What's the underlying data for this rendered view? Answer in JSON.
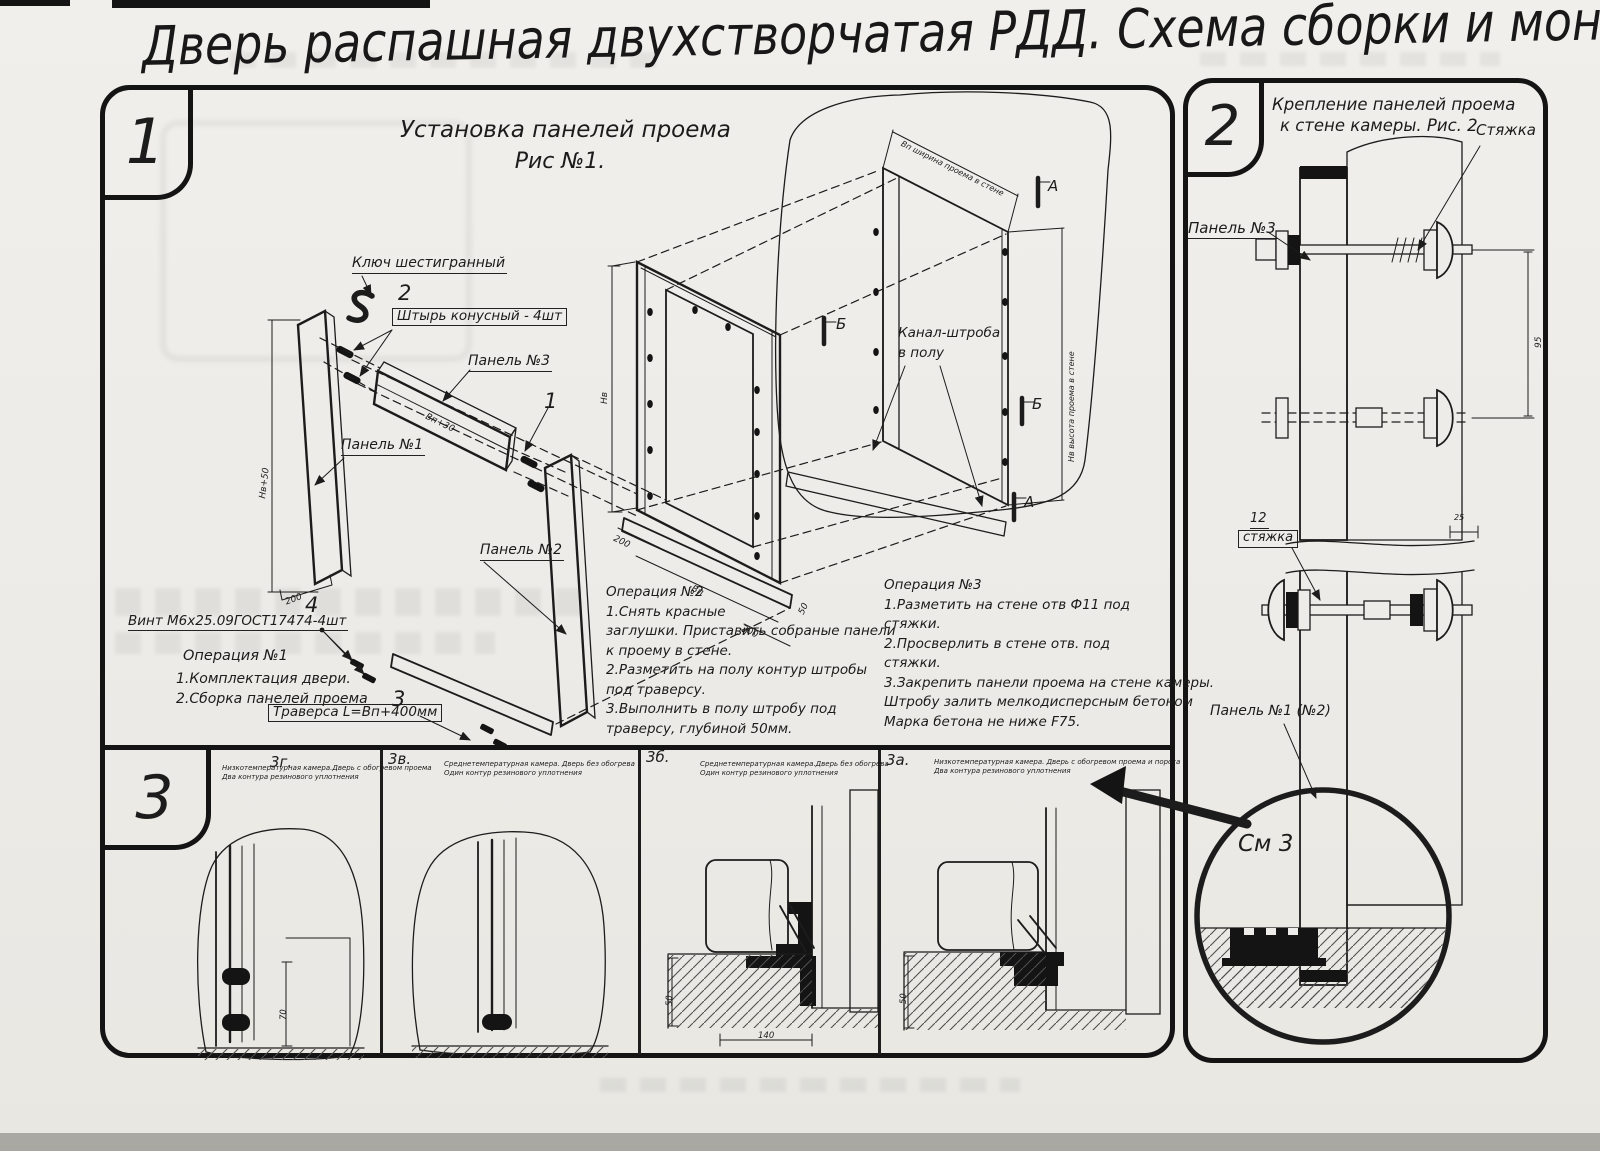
{
  "title": "Дверь распашная двухстворчатая РДД.  Схема сборки и монтажа №2",
  "s1": {
    "badge": "1",
    "title1": "Установка панелей проема",
    "title2": "Рис №1.",
    "lbl_key": "Ключ шестигранный",
    "lbl_pin": "Штырь конусный - 4шт",
    "lbl_p3": "Панель №3",
    "lbl_p1": "Панель №1",
    "lbl_p2": "Панель №2",
    "lbl_screw": "Винт М6х25.09ГОСТ17474-4шт",
    "lbl_trav": "Траверса  L=Вп+400мм",
    "c1": "1",
    "c2": "2",
    "c3": "3",
    "c4": "4",
    "op1_t": "Операция №1",
    "op1_lines": [
      "1.Комплектация двери.",
      "2.Сборка панелей проема"
    ],
    "op2_t": "Операция №2",
    "op2_lines": [
      "1.Снять красные",
      "заглушки. Приставить собраные панели",
      "к проему в стене.",
      "2.Разметить на полу контур штробы",
      "под траверсу.",
      "3.Выполнить в полу штробу под",
      "траверсу, глубиной 50мм."
    ],
    "op3_t": "Операция №3",
    "op3_lines": [
      "1.Разметить на стене отв Ф11 под",
      "стяжки.",
      "2.Просверлить в стене отв.  под",
      "стяжки.",
      "3.Закрепить панели проема на стене камеры.",
      "Штробу залить мелкодисперсным бетоном",
      "Марка бетона не ниже  F75."
    ],
    "chan1": "Канал-штроба",
    "chan2": "в полу",
    "mA": "А",
    "mB": "Б",
    "dim_h150": "Нв+50",
    "dim_200": "200",
    "dim_b30": "Вп+30",
    "dim_hn": "Нв",
    "dim_bn": "Вп",
    "dim_50": "50",
    "dim_wall_w": "Вп ширина проема в стене",
    "dim_wall_h": "Нв высота проема в стене"
  },
  "s2": {
    "badge": "2",
    "title1": "Крепление панелей проема",
    "title2": "к стене камеры. Рис. 2",
    "lbl_tie": "Стяжка",
    "lbl_p3": "Панель №3",
    "lbl_12": "12",
    "lbl_tie2": "стяжка",
    "lbl_p12": "Панель №1 (№2)",
    "see3": "См 3",
    "dim95": "95",
    "dim25": "25"
  },
  "s3": {
    "badge": "3",
    "panels": [
      {
        "id": "3г.",
        "cap1": "Низкотемпературная камера.Дверь с обогревом проема",
        "cap2": "Два контура резинового уплотнения"
      },
      {
        "id": "3в.",
        "cap1": "Среднетемпературная камера. Дверь без обогрева",
        "cap2": "Один контур резинового уплотнения"
      },
      {
        "id": "3б.",
        "cap1": "Среднетемпературная камера.Дверь без обогрева",
        "cap2": "Один контур резинового уплотнения"
      },
      {
        "id": "3а.",
        "cap1": "Низкотемпературная камера. Дверь с обогревом проема и порога",
        "cap2": "Два контура резинового уплотнения"
      }
    ],
    "dim70": "70",
    "dim50": "50",
    "dim140": "140"
  }
}
